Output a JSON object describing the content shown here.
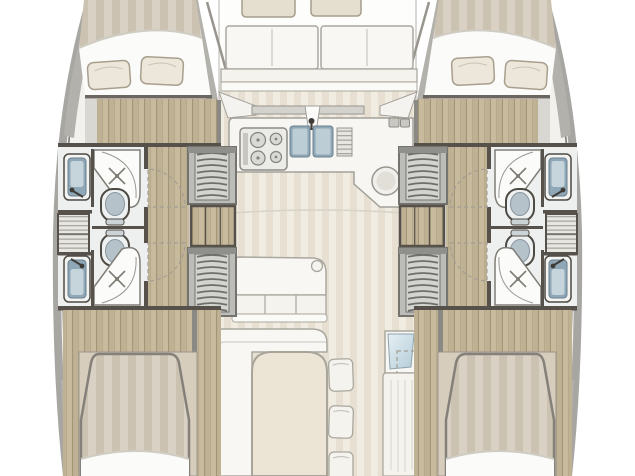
{
  "vessel": {
    "title": "Catamaran interior floor plan",
    "view": "top-down",
    "symmetry": "port and starboard hulls mirrored",
    "cabin_count": 4,
    "head_count": 4,
    "berths": [
      "port-forward-double",
      "port-aft-double",
      "starboard-forward-double",
      "starboard-aft-double"
    ]
  },
  "hulls": {
    "port": {
      "rooms": [
        {
          "name": "forward-cabin",
          "fixtures": [
            "double-berth",
            "pillows x2",
            "folded-sheet",
            "wood-floor"
          ]
        },
        {
          "name": "forward-head",
          "fixtures": [
            "washbasin",
            "faucet",
            "shower-pan",
            "shower-door",
            "toilet",
            "door-swing"
          ]
        },
        {
          "name": "midship-storage",
          "fixtures": [
            "shelf-steps"
          ]
        },
        {
          "name": "aft-head",
          "fixtures": [
            "washbasin",
            "faucet",
            "shower-pan",
            "shower-door",
            "toilet",
            "door-swing"
          ]
        },
        {
          "name": "companionway-forward",
          "fixtures": [
            "stairs"
          ]
        },
        {
          "name": "midship-cabinet",
          "fixtures": [
            "wood-lockers x3"
          ]
        },
        {
          "name": "companionway-aft",
          "fixtures": [
            "stairs"
          ]
        },
        {
          "name": "aft-cabin",
          "fixtures": [
            "double-berth",
            "folded-sheet",
            "headboard-panel",
            "wood-floor"
          ]
        }
      ]
    },
    "starboard": {
      "mirror_of": "port"
    }
  },
  "center": {
    "forward_cockpit": {
      "fixtures": [
        "bow-cushion x2",
        "seat-back x2",
        "bench",
        "step"
      ]
    },
    "galley": {
      "fixtures": [
        "cooktop-4-burner",
        "double-sink",
        "faucet",
        "drainer-board",
        "round-basin",
        "l-counter",
        "backsplash",
        "small-appliances x2"
      ]
    },
    "salon": {
      "fixtures": [
        "settee-3-seat",
        "corner-detail",
        "l-bench",
        "dining-table",
        "stools x3",
        "floor-seam"
      ]
    },
    "starboard_aft": {
      "fixtures": [
        "nav-cabinet",
        "glass-panel",
        "molded-bench",
        "door-swing-dashed"
      ]
    }
  },
  "colors": {
    "hull_interior": "#f2f1ed",
    "hull_band": "#a7a6a2",
    "hull_edge": "#7d7b76",
    "deck_wedge": "#b3b1ac",
    "deck_base": "#d9d1c3",
    "deck_stripe": "#ccc2b1",
    "sheet_white": "#fbfbf9",
    "sheet_line": "#cfccc3",
    "pillow": "#ece7da",
    "pillow_line": "#a89f8e",
    "bed_shadow": "#6b6760",
    "bed_rim": "#85817a",
    "wood_base": "#c8bb9d",
    "wood_alt": "#bfb193",
    "wood_line": "#a39676",
    "bulkhead": "#56524b",
    "bath_floor": "#eef0ef",
    "dark_line": "#4e4a44",
    "shower_fill": "#fbfbfa",
    "shower_line": "#807d76",
    "toilet_body": "#eef1f2",
    "toilet_seat": "#b5c2ca",
    "toilet_hinge": "#ccd3d7",
    "sink_outer": "#f3f3f1",
    "sink_basin": "#8fa7b6",
    "sink_inner": "#c6d4dc",
    "stair_frame": "#8f8f8b",
    "stair_base": "#d3d3d0",
    "stair_tread": "#6e6e6a",
    "stair_rail": "#bcbcb9",
    "salon_base": "#f1ece2",
    "salon_stripe": "#e7e0d2",
    "furn_white": "#f8f7f3",
    "furn_line": "#aaa79f",
    "counter": "#f7f6f2",
    "counter_line": "#a3a09a",
    "cushion": "#e5dfd0",
    "cushion_line": "#a59d8b",
    "drain_base": "#e7e6e1",
    "drain_line": "#a9a7a1",
    "glass_light": "#e6f0f4",
    "glass_dark": "#b3ccd8",
    "headboard": "#d6cdbd",
    "table_fill": "#ece5d6",
    "arc_line": "#a39e94",
    "metal_dark": "#3f3c37",
    "backsplash": "#d3d2cd",
    "background": "#ffffff"
  }
}
